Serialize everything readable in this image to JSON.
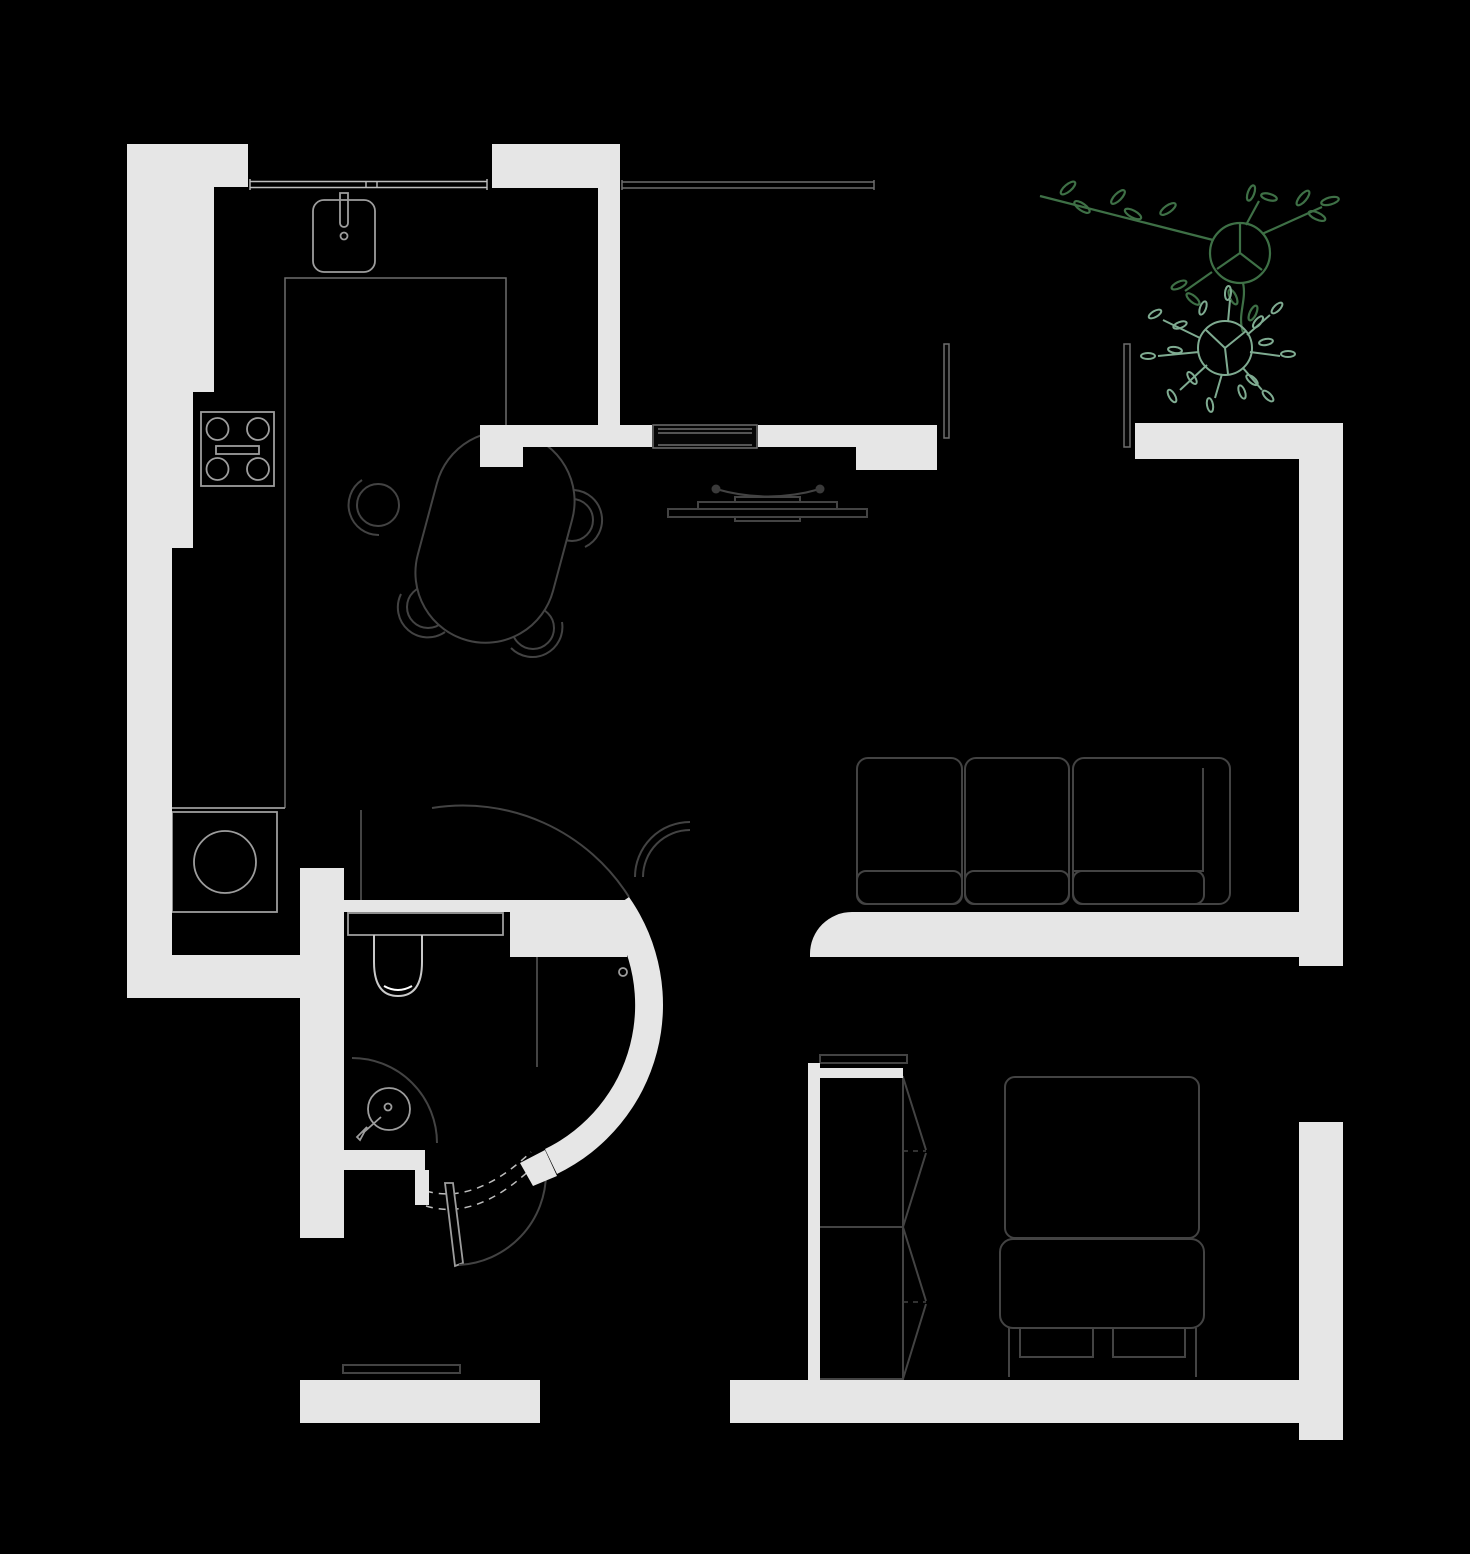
{
  "document": {
    "kind": "apartment-floor-plan",
    "width_px": 1470,
    "height_px": 1554,
    "visible_text": ""
  },
  "colors": {
    "background": "#000000",
    "wall-fill": "#e6e6e6",
    "furniture-stroke": "#434343",
    "fixture-stroke": "#9d9d9d",
    "mid-stroke": "#6e6e6e",
    "faint-stroke": "#bdbdbd",
    "highlight": "#ffffff",
    "plant-dark-green": "#3e7046",
    "plant-light-green": "#7fab91"
  },
  "icons": [
    "kitchen-sink-icon",
    "faucet-icon",
    "stove-icon",
    "burner-icon",
    "kitchen-counter",
    "washing-machine-icon",
    "window-band",
    "dining-table-icon",
    "dining-chair-icon",
    "entry-door-icon",
    "wall-fin",
    "coat-rack-icon",
    "sofa-icon",
    "wardrobe-icon",
    "double-bed-icon",
    "bed-drawer",
    "toilet-icon",
    "washbasin-icon",
    "shower-glass-wall",
    "curved-wall",
    "bathroom-door-icon",
    "door-swing-arc",
    "sliding-door-track",
    "plant-icon-dark",
    "plant-icon-light",
    "threshold"
  ]
}
